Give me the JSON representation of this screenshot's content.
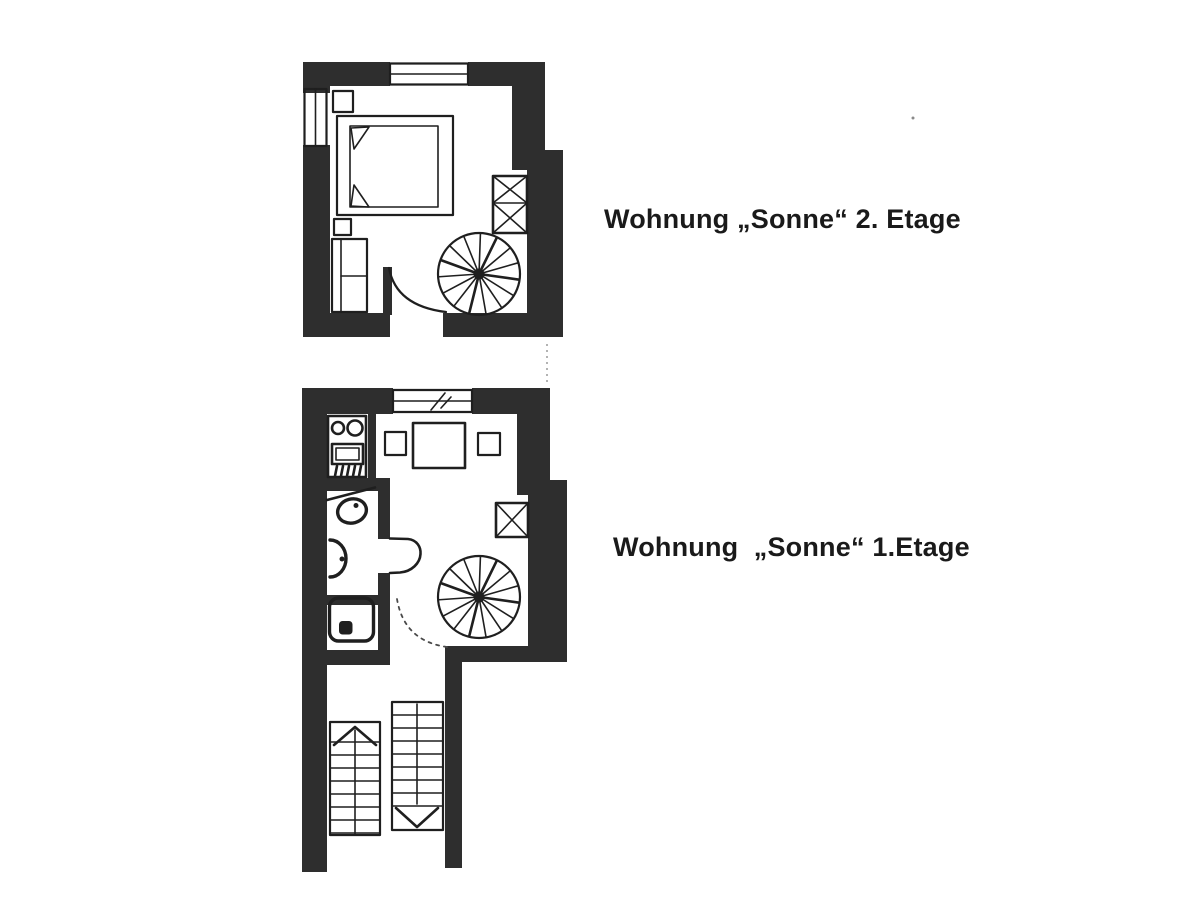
{
  "page": {
    "background": "#ffffff",
    "ink": "#1f1f1f",
    "wall_fill": "#2e2e2e",
    "caption_color": "#1a1a1a"
  },
  "captions": {
    "floor2": "Wohnung „Sonne“ 2. Etage",
    "floor1": "Wohnung  „Sonne“ 1.Etage"
  },
  "icons": {
    "spiral_staircase": "spiral-staircase-icon",
    "straight_stairs": "straight-stairs-icon",
    "bed": "double-bed-icon",
    "wardrobe": "wardrobe-icon",
    "stove": "stove-burners-icon",
    "sink": "kitchen-sink-icon",
    "washbasin": "washbasin-icon",
    "toilet": "toilet-icon",
    "shower": "shower-tray-icon",
    "table": "dining-table-icon",
    "window": "window-icon",
    "door_swing": "door-swing-icon"
  }
}
